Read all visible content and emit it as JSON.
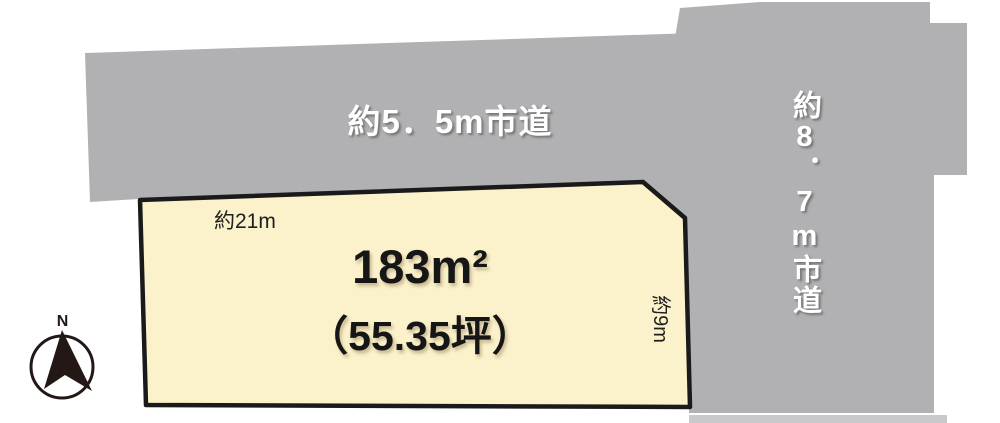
{
  "diagram": {
    "roads": {
      "top_road_label": "約5．5m市道",
      "right_road_label": "約8．7m市道",
      "road_color": "#B1B1B3",
      "road_edge_color": "#C9C9CB",
      "label_color": "#FFFFFF"
    },
    "plot": {
      "area_label": "183m²",
      "area_tsubo_label": "（55.35坪）",
      "frontage_label": "約21m",
      "depth_label": "約9m",
      "fill_color": "#FBF1CA",
      "border_color": "#1A1A1A",
      "text_color": "#161616"
    },
    "compass": {
      "north_label": "N",
      "color": "#231815"
    }
  }
}
